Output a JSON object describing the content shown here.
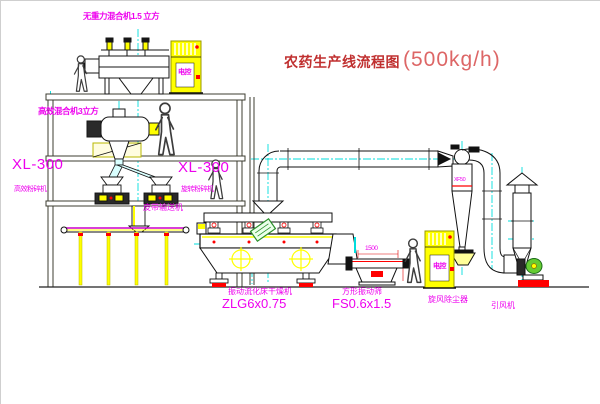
{
  "title": {
    "cn": "农药生产线流程图",
    "capacity": "(500kg/h)"
  },
  "labels": {
    "top_mixer": "无重力混合机1.5 立方",
    "mixer2": "高效混合机3立方",
    "mill_left_model": "XL-300",
    "mill_left_name": "高效粉碎机",
    "mill_right_model": "XL-300",
    "mill_right_name": "旋转粉碎机",
    "belt": "皮带输送机",
    "dryer_name": "振动流化床干燥机",
    "dryer_model": "ZLG6x0.75",
    "screen_name": "方形振动筛",
    "screen_model": "FS0.6x1.5",
    "cyclone": "旋风除尘器",
    "fan": "引风机",
    "dim_1500": "1500",
    "cyclone_model": "XF50",
    "cabinet_text": "电控"
  },
  "colors": {
    "magenta": "#ee00ee",
    "title_red": "#c03030",
    "capacity_red": "#dd6666",
    "line_yellow": "#ffff00",
    "centerline_cyan": "#00dddd",
    "accent_red": "#ff0000",
    "stamp_green": "#2a8f2a"
  }
}
